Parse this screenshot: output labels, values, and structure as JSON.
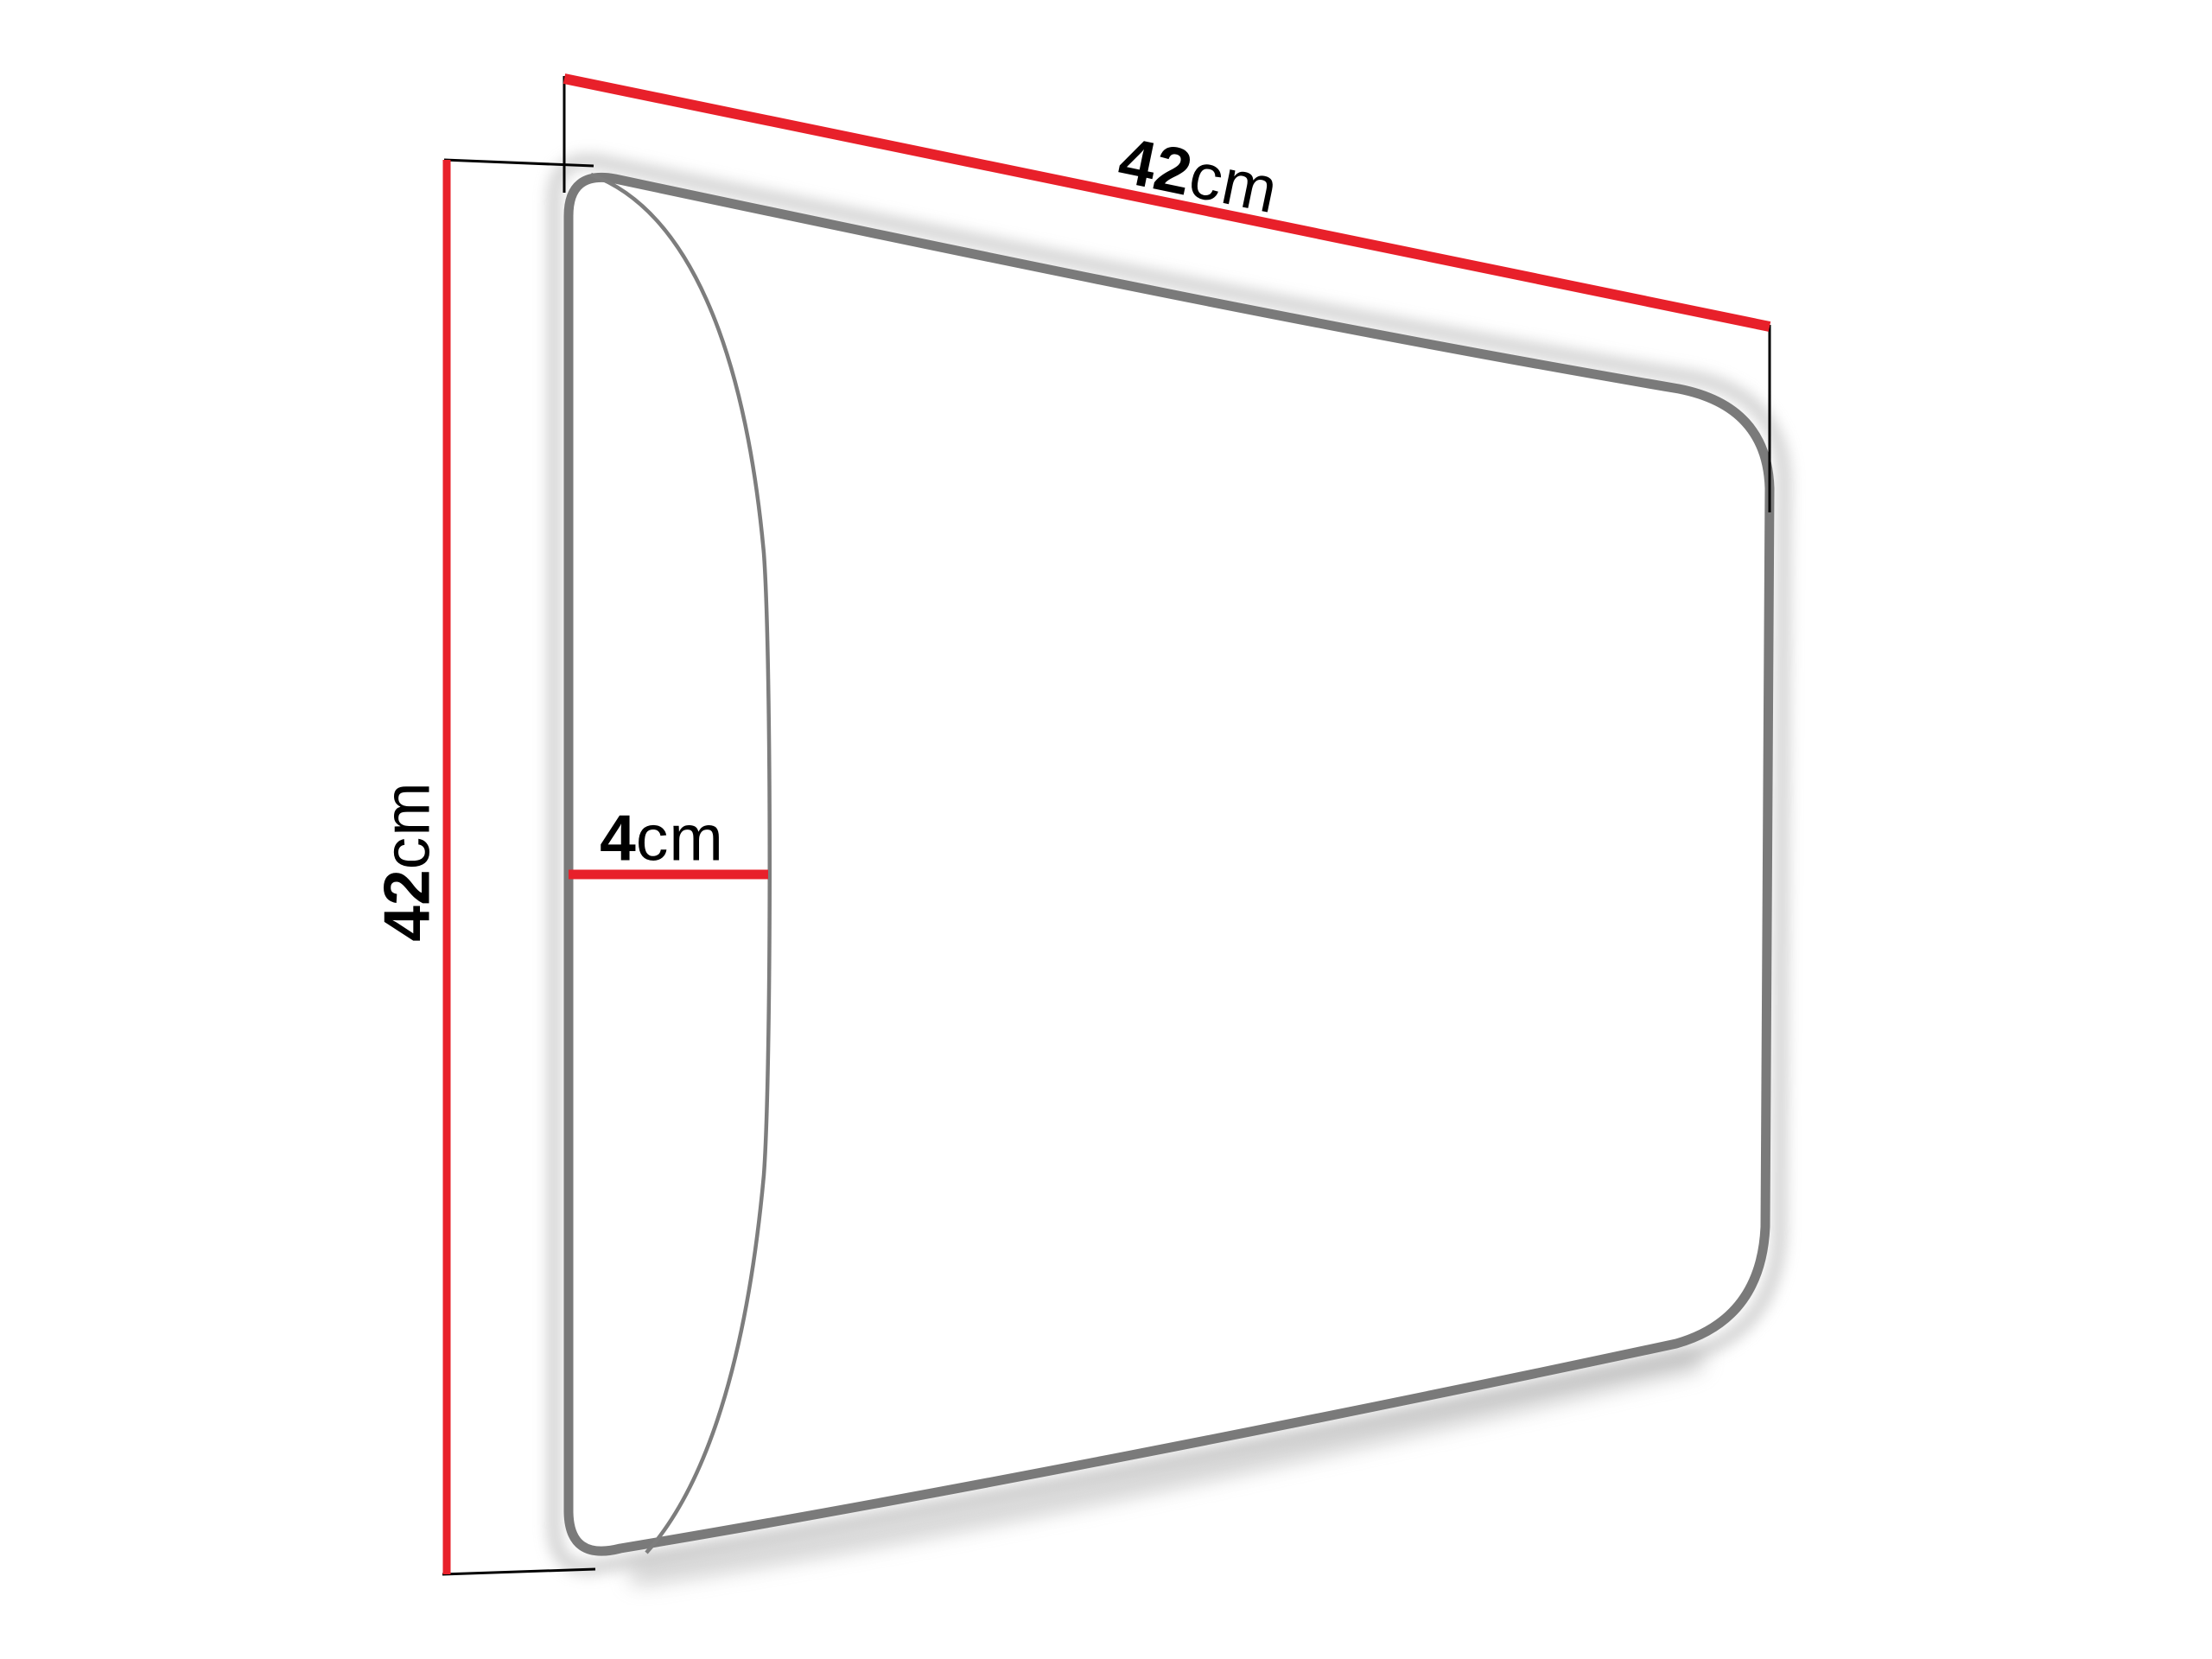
{
  "diagram": {
    "background_color": "#ffffff",
    "panel_outline_color": "#7a7a7a",
    "panel_face_color": "#ffffff",
    "dimension_line_color": "#e8202a",
    "extension_line_color": "#000000",
    "label_color": "#000000",
    "dimensions": {
      "width": {
        "value": "42",
        "unit": "cm"
      },
      "height": {
        "value": "42",
        "unit": "cm"
      },
      "depth": {
        "value": "4",
        "unit": "cm"
      }
    }
  }
}
